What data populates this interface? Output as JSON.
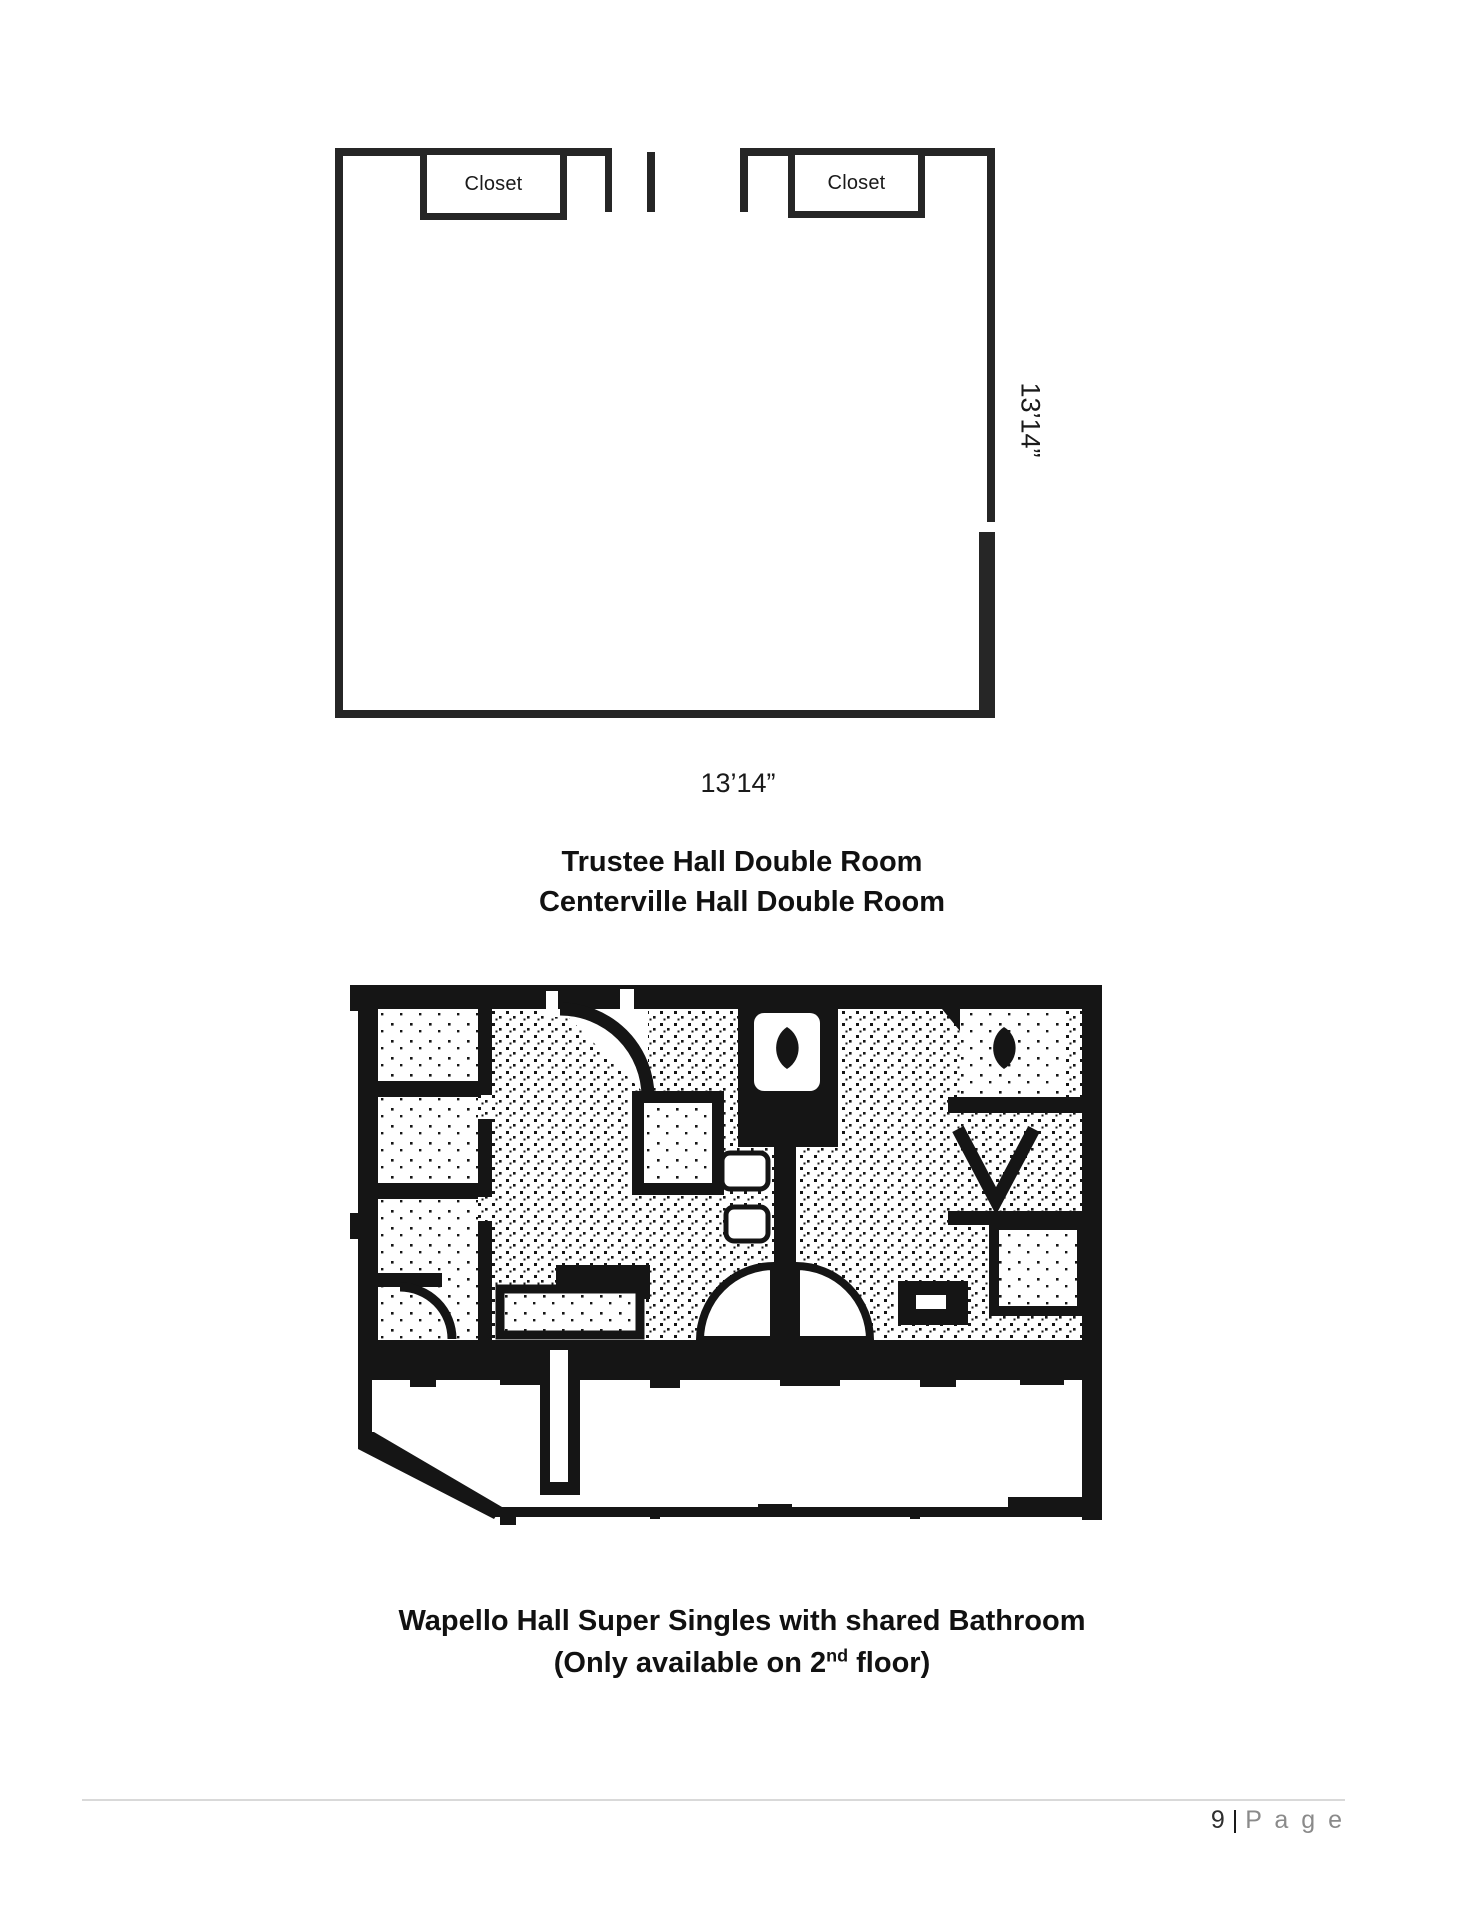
{
  "page": {
    "room_diagram": {
      "closet_left_label": "Closet",
      "closet_right_label": "Closet",
      "height_dimension": "13’14”",
      "width_dimension": "13’14”"
    },
    "caption_top": {
      "line1": "Trustee Hall Double Room",
      "line2": "Centerville Hall Double Room"
    },
    "caption_bottom": {
      "line1": "Wapello Hall Super Singles with shared Bathroom",
      "line2_prefix": "(Only available on 2",
      "line2_superscript": "nd",
      "line2_suffix": " floor)"
    },
    "footer": {
      "page_number": "9",
      "separator": "|",
      "page_word": "P a g e"
    },
    "colors": {
      "diagram_wall": "#262626",
      "plan_ink": "#151515",
      "footer_gray": "#8a8a8a",
      "rule_gray": "#d9d9d9"
    }
  }
}
